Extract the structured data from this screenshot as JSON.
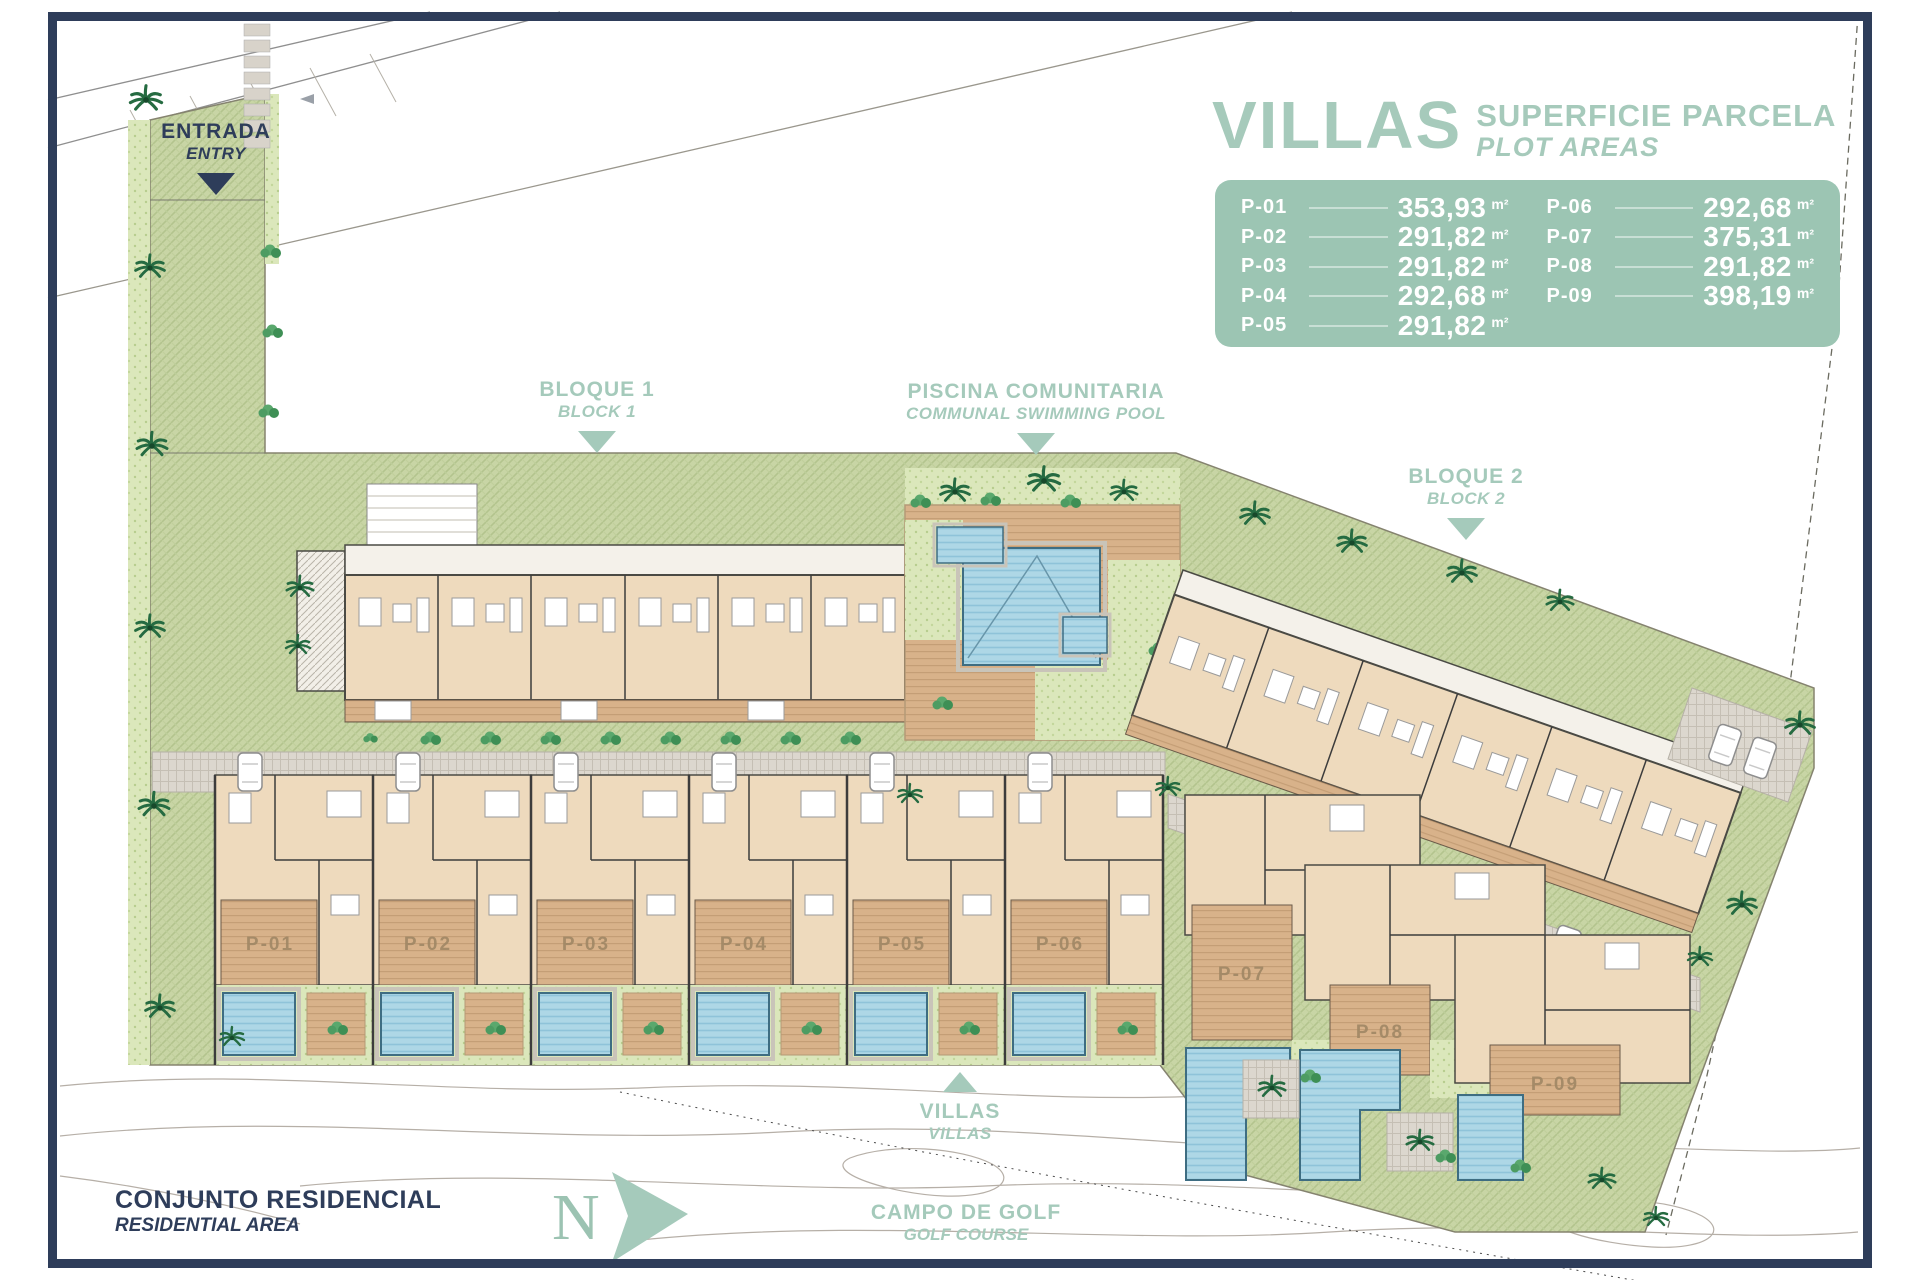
{
  "palette": {
    "navy": "#2e3d5a",
    "accent_green": "#a5cabb",
    "panel_green": "#9cc5b3",
    "lawn_green": "#c8d5a5",
    "deck_tan": "#d8b28a",
    "pool_blue": "#aed7e6"
  },
  "legend": {
    "title": "VILLAS",
    "subtitle_es": "SUPERFICIE PARCELA",
    "subtitle_en": "PLOT AREAS",
    "unit_suffix": "m²",
    "plots": [
      {
        "id": "P-01",
        "area": "353,93"
      },
      {
        "id": "P-02",
        "area": "291,82"
      },
      {
        "id": "P-03",
        "area": "291,82"
      },
      {
        "id": "P-04",
        "area": "292,68"
      },
      {
        "id": "P-05",
        "area": "291,82"
      },
      {
        "id": "P-06",
        "area": "292,68"
      },
      {
        "id": "P-07",
        "area": "375,31"
      },
      {
        "id": "P-08",
        "area": "291,82"
      },
      {
        "id": "P-09",
        "area": "398,19"
      }
    ]
  },
  "labels": {
    "entry": {
      "es": "ENTRADA",
      "en": "ENTRY"
    },
    "block1": {
      "es": "BLOQUE 1",
      "en": "BLOCK 1"
    },
    "pool": {
      "es": "PISCINA COMUNITARIA",
      "en": "COMMUNAL SWIMMING POOL"
    },
    "block2": {
      "es": "BLOQUE 2",
      "en": "BLOCK 2"
    },
    "villas_marker": {
      "es": "VILLAS",
      "en": "VILLAS"
    },
    "residential": {
      "es": "CONJUNTO RESIDENCIAL",
      "en": "RESIDENTIAL AREA"
    },
    "golf": {
      "es": "CAMPO DE GOLF",
      "en": "GOLF COURSE"
    },
    "north": "N"
  },
  "map": {
    "villa_plot_labels": [
      "P-01",
      "P-02",
      "P-03",
      "P-04",
      "P-05",
      "P-06",
      "P-07",
      "P-08",
      "P-09"
    ]
  }
}
